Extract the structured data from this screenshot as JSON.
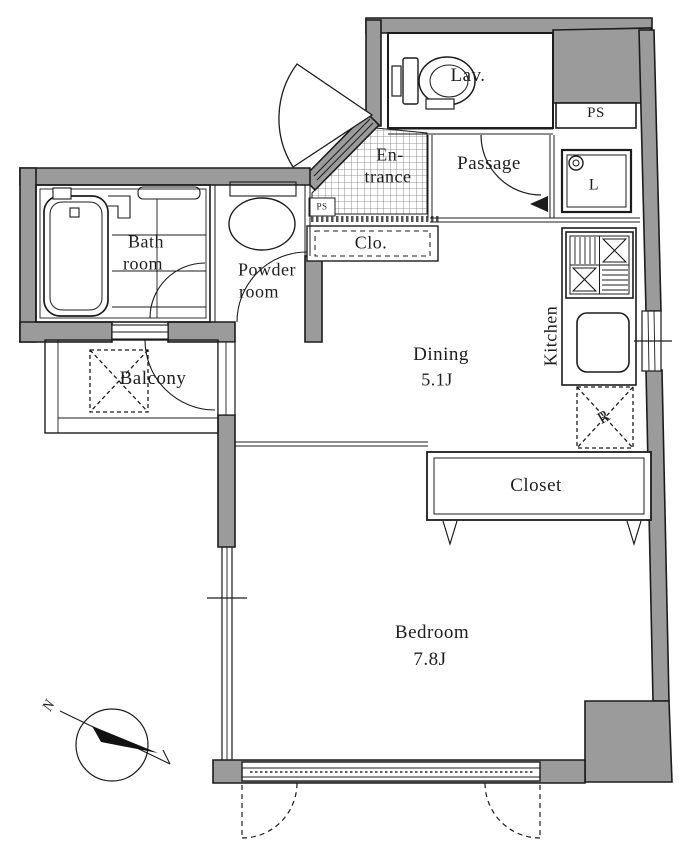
{
  "floorplan": {
    "rooms": {
      "lav": {
        "label": "Lav."
      },
      "ps_upper": {
        "label": "PS"
      },
      "ps_lower": {
        "label": "PS"
      },
      "entrance": {
        "line1": "En-",
        "line2": "trance"
      },
      "passage": {
        "label": "Passage"
      },
      "laundry": {
        "label": "L"
      },
      "hall_closet": {
        "label": "Clo."
      },
      "kitchen": {
        "label": "Kitchen"
      },
      "dining": {
        "label": "Dining",
        "size": "5.1J"
      },
      "closet": {
        "label": "Closet"
      },
      "bathroom": {
        "line1": "Bath",
        "line2": "room"
      },
      "powder_room": {
        "line1": "Powder",
        "line2": "room"
      },
      "balcony": {
        "label": "Balcony"
      },
      "bedroom": {
        "label": "Bedroom",
        "size": "7.8J"
      },
      "refrigerator": {
        "label": "R"
      }
    },
    "compass": {
      "north": "N"
    },
    "colors": {
      "wall_fill": "#9b9b9b",
      "line": "#1c1c1c",
      "background": "#ffffff"
    }
  }
}
